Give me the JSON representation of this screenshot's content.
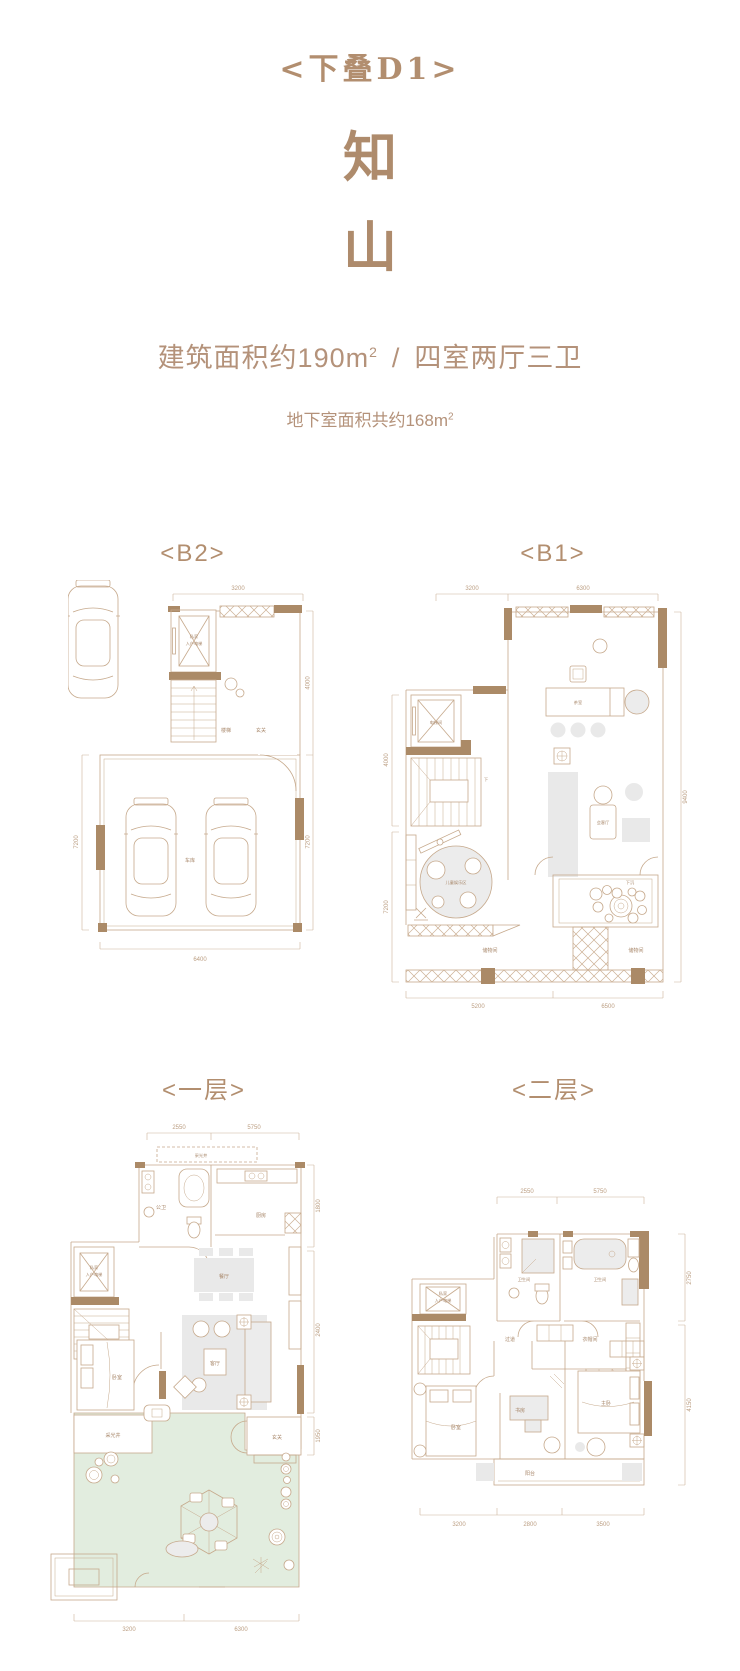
{
  "header": {
    "plan_tag": "<下叠D1>",
    "name_char_1": "知",
    "name_char_2": "山",
    "area_main": "建筑面积约190m",
    "area_sup": "2",
    "area_divider": "/",
    "area_rooms": "四室两厅三卫",
    "basement_main": "地下室面积共约168m",
    "basement_sup": "2"
  },
  "colors": {
    "accent_text": "#b28e6f",
    "wall_fill": "#ab8a67",
    "line": "#c6a98c",
    "furniture_fill": "#e9e9e9",
    "garden_green": "#e2eddf"
  },
  "plan_b2": {
    "title": "<B2>",
    "labels": {
      "elevator_line1": "私家",
      "elevator_line2": "入户电梯",
      "stairs": "楼梯",
      "foyer": "玄关",
      "garage": "车库"
    },
    "dims": {
      "top": "3200",
      "left": "7200",
      "right_top": "4000",
      "right_bottom": "7200",
      "bottom": "6400"
    }
  },
  "plan_b1": {
    "title": "<B1>",
    "labels": {
      "elevator": "电梯间",
      "stairs_down": "下",
      "tea_room": "茶室",
      "lounge": "会客厅",
      "kids_area": "儿童娱乐区",
      "sunken_yard": "下沉",
      "storage_left": "储物间",
      "storage_right": "储物间"
    },
    "dims": {
      "top_left": "3200",
      "top_right": "6300",
      "left_top": "4000",
      "left_bottom": "7200",
      "right": "9400",
      "bottom_left": "5200",
      "bottom_right": "6500"
    }
  },
  "plan_f1": {
    "title": "<一层>",
    "labels": {
      "light_well_top": "采光井",
      "guest_bath": "公卫",
      "kitchen": "厨房",
      "dining": "餐厅",
      "living": "客厅",
      "bedroom": "卧室",
      "elevator_line1": "私家",
      "elevator_line2": "入户电梯",
      "light_well_bottom": "采光井",
      "foyer": "玄关"
    },
    "dims": {
      "top_left": "2550",
      "top_right": "5750",
      "right_top": "1800",
      "right_mid": "2400",
      "right_bottom": "1950",
      "bottom_left": "3200",
      "bottom_right": "6300"
    }
  },
  "plan_f2": {
    "title": "<二层>",
    "labels": {
      "bath_left": "卫生间",
      "bath_right": "卫生间",
      "hallway": "过道",
      "cloakroom": "衣帽间",
      "elevator_line1": "私家",
      "elevator_line2": "入户电梯",
      "bedroom": "卧室",
      "study": "书房",
      "master_bedroom": "主卧",
      "balcony": "阳台"
    },
    "dims": {
      "top_left": "2550",
      "top_right": "5750",
      "right_top": "2750",
      "right_bottom": "4150",
      "bottom_left": "3200",
      "bottom_mid": "2800",
      "bottom_right": "3500"
    }
  }
}
